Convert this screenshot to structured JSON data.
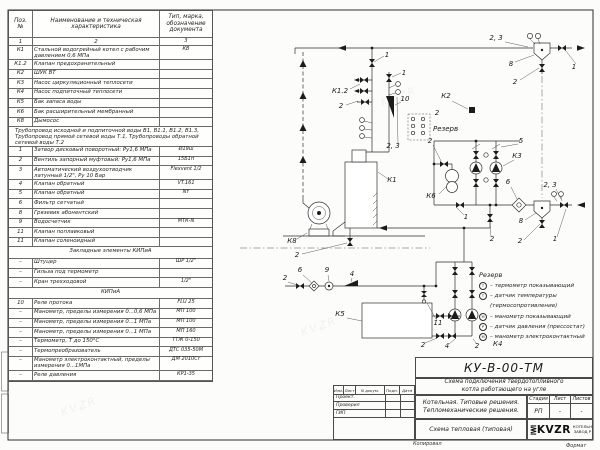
{
  "page": {
    "copied_label": "Копировал",
    "format_label": "Формат",
    "watermark": "KVZR"
  },
  "parts_table": {
    "header": {
      "pos": "Поз.\n№",
      "name": "Наименование и техническая характеристика",
      "doc": "Тип, марка, обозначение документа"
    },
    "col_numbers": [
      "1",
      "2",
      "3"
    ],
    "rows": [
      {
        "pos": "К1",
        "name": "Стальной водогрейный котел с рабочим давлением 0,6 МПа",
        "doc": "КВ",
        "tall": true
      },
      {
        "pos": "К1.2",
        "name": "Клапан предохранительный",
        "doc": ""
      },
      {
        "pos": "К2",
        "name": "ШУК ВТ",
        "doc": ""
      },
      {
        "pos": "К3",
        "name": "Насос циркуляционный теплосети",
        "doc": ""
      },
      {
        "pos": "К4",
        "name": "Насос подпиточный теплосети",
        "doc": ""
      },
      {
        "pos": "К5",
        "name": "Бак запаса воды",
        "doc": ""
      },
      {
        "pos": "К6",
        "name": "Бак расширительный мембранный",
        "doc": ""
      },
      {
        "pos": "К8",
        "name": "Дымосос",
        "doc": ""
      },
      {
        "note": "Трубопровод исходной и подпиточной воды В1, В1.1, В1.2, В1.3, Трубопровод прямой сетевой воды Т.1, Трубопроводы обратной сетевой воды Т.2"
      },
      {
        "pos": "1",
        "name": "Затвор дисковый поворотный: Ру1,6 МПа",
        "doc": "Ø19ш"
      },
      {
        "pos": "2",
        "name": "Вентиль запорный муфтовый: Ру1,6 МПа",
        "doc": "15Б1п"
      },
      {
        "pos": "3",
        "name": "Автоматический воздухоотводчик латунный 1/2\", Ру 10 Бар",
        "doc": "Flexvent 1/2",
        "tall": true
      },
      {
        "pos": "4",
        "name": "Клапан обратный",
        "doc": "VT.161"
      },
      {
        "pos": "5",
        "name": "Клапан обратный",
        "doc": "NY"
      },
      {
        "pos": "6",
        "name": "Фильтр сетчатый",
        "doc": ""
      },
      {
        "pos": "8",
        "name": "Грязевик абонентский",
        "doc": ""
      },
      {
        "pos": "9",
        "name": "Водосчетчик",
        "doc": "МТК-N"
      },
      {
        "pos": "11",
        "name": "Клапан поплавковый",
        "doc": ""
      },
      {
        "pos": "11",
        "name": "Клапан соленоидный",
        "doc": ""
      },
      {
        "section": "Закладные элементы КИПиА"
      },
      {
        "pos": "–",
        "name": "Штуцер",
        "doc": "ШР 1/2\""
      },
      {
        "pos": "–",
        "name": "Гильза под термометр",
        "doc": ""
      },
      {
        "pos": "–",
        "name": "Кран трехходовой",
        "doc": "1/2\""
      },
      {
        "section": "КИПиА"
      },
      {
        "pos": "10",
        "name": "Реле протока",
        "doc": "FLU 25"
      },
      {
        "pos": "–",
        "name": "Манометр, пределы измерения 0...0,6 МПа",
        "doc": "МП 100"
      },
      {
        "pos": "–",
        "name": "Манометр, пределы измерения 0...1 МПа",
        "doc": "МП 100"
      },
      {
        "pos": "–",
        "name": "Манометр, пределы измерения 0...1 МПа",
        "doc": "МП 160"
      },
      {
        "pos": "–",
        "name": "Термометр, Т до 150°С",
        "doc": "ТТЖ 0-150"
      },
      {
        "pos": "–",
        "name": "Термопреобразователь",
        "doc": "ДТС 035-50М"
      },
      {
        "pos": "–",
        "name": "Манометр электроконтактный, пределы измерения 0...1МПа",
        "doc": "ДМ 2010Сг",
        "tall": true
      },
      {
        "pos": "–",
        "name": "Реле давления",
        "doc": "КР1-35"
      }
    ]
  },
  "schematic": {
    "callouts": [
      {
        "t": "2, 3",
        "x": 496,
        "y": 40,
        "l": [
          505,
          42,
          528,
          47
        ]
      },
      {
        "t": "8",
        "x": 511,
        "y": 66,
        "l": [
          515,
          62,
          534,
          55
        ]
      },
      {
        "t": "1",
        "x": 574,
        "y": 69,
        "l": [
          576,
          64,
          566,
          51
        ]
      },
      {
        "t": "2",
        "x": 515,
        "y": 84,
        "l": [
          520,
          80,
          539,
          68
        ]
      },
      {
        "t": "1",
        "x": 387,
        "y": 57,
        "l": [
          384,
          56,
          374,
          62
        ]
      },
      {
        "t": "К1.2",
        "x": 340,
        "y": 93,
        "l": [
          350,
          89,
          360,
          84
        ]
      },
      {
        "t": "2",
        "x": 341,
        "y": 108,
        "l": [
          346,
          105,
          358,
          101
        ]
      },
      {
        "t": "1",
        "x": 404,
        "y": 75,
        "l": [
          401,
          73,
          392,
          77
        ]
      },
      {
        "t": "10",
        "x": 405,
        "y": 101,
        "l": [
          401,
          102,
          395,
          105
        ]
      },
      {
        "t": "Резерв",
        "x": 433,
        "y": 131,
        "anchor": "start"
      },
      {
        "t": "К2",
        "x": 446,
        "y": 98,
        "l": [
          452,
          101,
          468,
          109
        ]
      },
      {
        "t": "2",
        "x": 437,
        "y": 115
      },
      {
        "t": "2",
        "x": 430,
        "y": 143,
        "l": [
          433,
          145,
          441,
          161
        ]
      },
      {
        "t": "2, 3",
        "x": 393,
        "y": 148,
        "l": [
          398,
          144,
          397,
          97
        ]
      },
      {
        "t": "К1",
        "x": 392,
        "y": 182,
        "l": [
          388,
          179,
          378,
          172
        ]
      },
      {
        "t": "5",
        "x": 521,
        "y": 143,
        "l": [
          518,
          144,
          501,
          147
        ]
      },
      {
        "t": "К3",
        "x": 517,
        "y": 158,
        "l": [
          514,
          160,
          503,
          166
        ]
      },
      {
        "t": "К6",
        "x": 431,
        "y": 198,
        "l": [
          439,
          194,
          447,
          186
        ]
      },
      {
        "t": "6",
        "x": 508,
        "y": 184,
        "l": [
          511,
          187,
          517,
          199
        ]
      },
      {
        "t": "2, 3",
        "x": 550,
        "y": 187,
        "l": [
          556,
          189,
          561,
          199
        ]
      },
      {
        "t": "1",
        "x": 466,
        "y": 219,
        "l": [
          464,
          215,
          457,
          208
        ]
      },
      {
        "t": "8",
        "x": 521,
        "y": 223,
        "l": [
          525,
          220,
          536,
          213
        ]
      },
      {
        "t": "1",
        "x": 555,
        "y": 241,
        "l": [
          557,
          237,
          566,
          209
        ]
      },
      {
        "t": "2",
        "x": 520,
        "y": 243,
        "l": [
          524,
          240,
          540,
          224
        ]
      },
      {
        "t": "2",
        "x": 492,
        "y": 241,
        "l": [
          491,
          237,
          490,
          222
        ]
      },
      {
        "t": "К8",
        "x": 292,
        "y": 243,
        "l": [
          297,
          239,
          307,
          233
        ]
      },
      {
        "t": "2",
        "x": 297,
        "y": 257,
        "l": [
          302,
          254,
          347,
          243
        ]
      },
      {
        "t": "2",
        "x": 285,
        "y": 280,
        "l": [
          288,
          282,
          297,
          285
        ]
      },
      {
        "t": "6",
        "x": 300,
        "y": 272,
        "l": [
          303,
          275,
          312,
          283
        ]
      },
      {
        "t": "9",
        "x": 327,
        "y": 272,
        "l": [
          328,
          275,
          329,
          281
        ]
      },
      {
        "t": "4",
        "x": 352,
        "y": 276,
        "l": [
          352,
          278,
          351,
          282
        ]
      },
      {
        "t": "К5",
        "x": 340,
        "y": 316,
        "l": [
          347,
          318,
          362,
          321
        ]
      },
      {
        "t": "11",
        "x": 438,
        "y": 325,
        "l": [
          437,
          321,
          427,
          303
        ]
      },
      {
        "t": "2",
        "x": 423,
        "y": 347,
        "l": [
          425,
          343,
          437,
          338
        ]
      },
      {
        "t": "4",
        "x": 447,
        "y": 348,
        "l": [
          449,
          344,
          455,
          339
        ]
      },
      {
        "t": "2",
        "x": 477,
        "y": 348,
        "l": [
          477,
          344,
          473,
          339
        ]
      },
      {
        "t": "К4",
        "x": 493,
        "y": 346,
        "anchor": "start"
      }
    ],
    "legend": {
      "reserve_label": "Резерв",
      "items": [
        {
          "sym": "Т",
          "text": "– термометр показывающий"
        },
        {
          "sym": "Т",
          "text": "– датчик температуры"
        },
        {
          "sym": "",
          "text": "(термосопротивление)"
        },
        {
          "sym": "М",
          "text": "– манометр показывающий"
        },
        {
          "sym": "Р",
          "text": "– датчик давления (прессостат)"
        },
        {
          "sym": "М",
          "text": "– манометр электроконтактный"
        }
      ]
    }
  },
  "titleblock": {
    "doc_code": "КУ-В-00-ТМ",
    "title_line1": "Схема подключения твердотопливного",
    "title_line2": "котла работающего на угле",
    "sig_header": {
      "izm": "Изм.",
      "list": "Лист",
      "ndoc": "N докум.",
      "podp": "Подп.",
      "data": "Дата"
    },
    "sig_rows": [
      "Проект.",
      "Проверил",
      "ГИП"
    ],
    "org_line1": "Котельная. Типовые решения.",
    "org_line2": "Тепломеханические решения.",
    "stage_label": "Стадия",
    "sheet_label": "Лист",
    "sheets_label": "Листов",
    "stage_value": "РП",
    "sheet_value": "-",
    "sheets_value": "-",
    "scheme_label": "Схема тепловая (типовая)",
    "logo_text": "KVZR",
    "logo_caption1": "КОТЕЛЬН",
    "logo_caption2": "ЗАВОД Р"
  }
}
